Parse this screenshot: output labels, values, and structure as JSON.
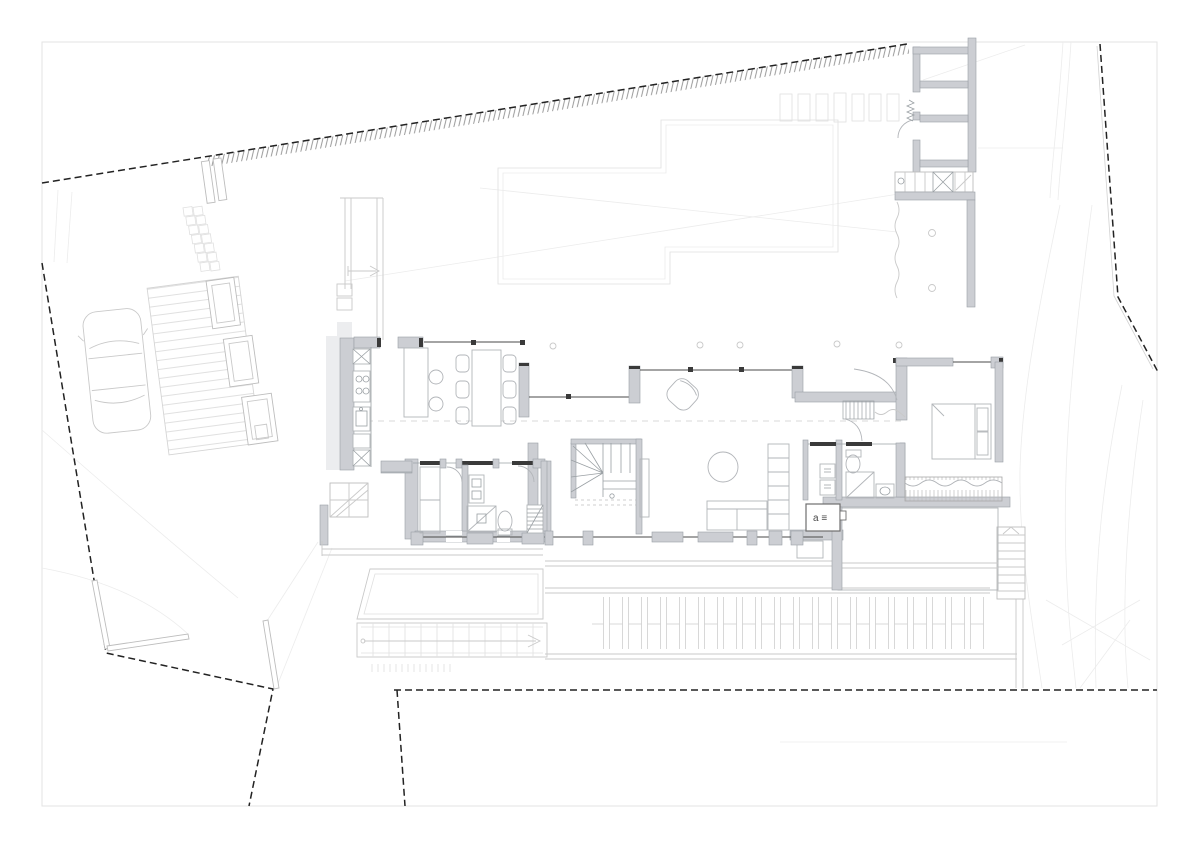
{
  "sheet": {
    "kind": "architectural-floor-plan-with-site",
    "width_px": 1200,
    "height_px": 848,
    "background": "#ffffff"
  },
  "labels": {
    "equipment_box": "a ≡"
  },
  "colors": {
    "boundary": "#222222",
    "boundary_hatch": "#8d8d8d",
    "wall_fill": "#ccced3",
    "wall_stroke": "#9aa0a6",
    "wall_dark": "#3a3a3a",
    "glass": "#4a4a4a",
    "site": "#c9c9c9",
    "faint": "#ececec",
    "paper": "#ffffff"
  },
  "boundary": {
    "style": "dashed",
    "hatched_top_edge": true
  },
  "site_features": [
    "property-boundary",
    "boundary-hatch-strip",
    "entrance-gate",
    "stepping-stone-path",
    "timber-deck-ramp",
    "planters",
    "parked-car",
    "retaining-walls",
    "driveway-opening",
    "upper-floor-outline",
    "skylight-row",
    "storage-building",
    "garden-ramp-hatched",
    "north-east-terrace",
    "lawn-terrace",
    "access-ramp-with-arrow",
    "grass-ticks",
    "louver-deck-band",
    "garden-stairs-east",
    "bedroom-terrace",
    "terrain-contours"
  ],
  "rooms": [
    "kitchen",
    "dining-area",
    "living-area",
    "stair-hall",
    "corridor",
    "utility-room",
    "bathroom",
    "entrance-hall",
    "laundry",
    "master-bathroom",
    "bedroom"
  ],
  "furniture": [
    "kitchen-counter",
    "cooktop",
    "sink",
    "kitchen-island",
    "bar-stools",
    "dining-table",
    "dining-chairs",
    "armchair",
    "coffee-table",
    "sofa",
    "bookshelf",
    "winder-stair",
    "ladder-stair",
    "wardrobe-utility",
    "shower",
    "toilet",
    "washbasin",
    "washer-dryer-stack",
    "equipment-box",
    "bed",
    "built-in-wardrobe"
  ],
  "counts": {
    "dining_chairs": 6,
    "bar_stools": 2,
    "skylights": 7,
    "louver_boards": 21,
    "deck_boards": 18,
    "planters": 3,
    "stepping_stones": 14,
    "column_markers": 5,
    "terrace_columns": 2,
    "east_stair_treads": 8
  }
}
